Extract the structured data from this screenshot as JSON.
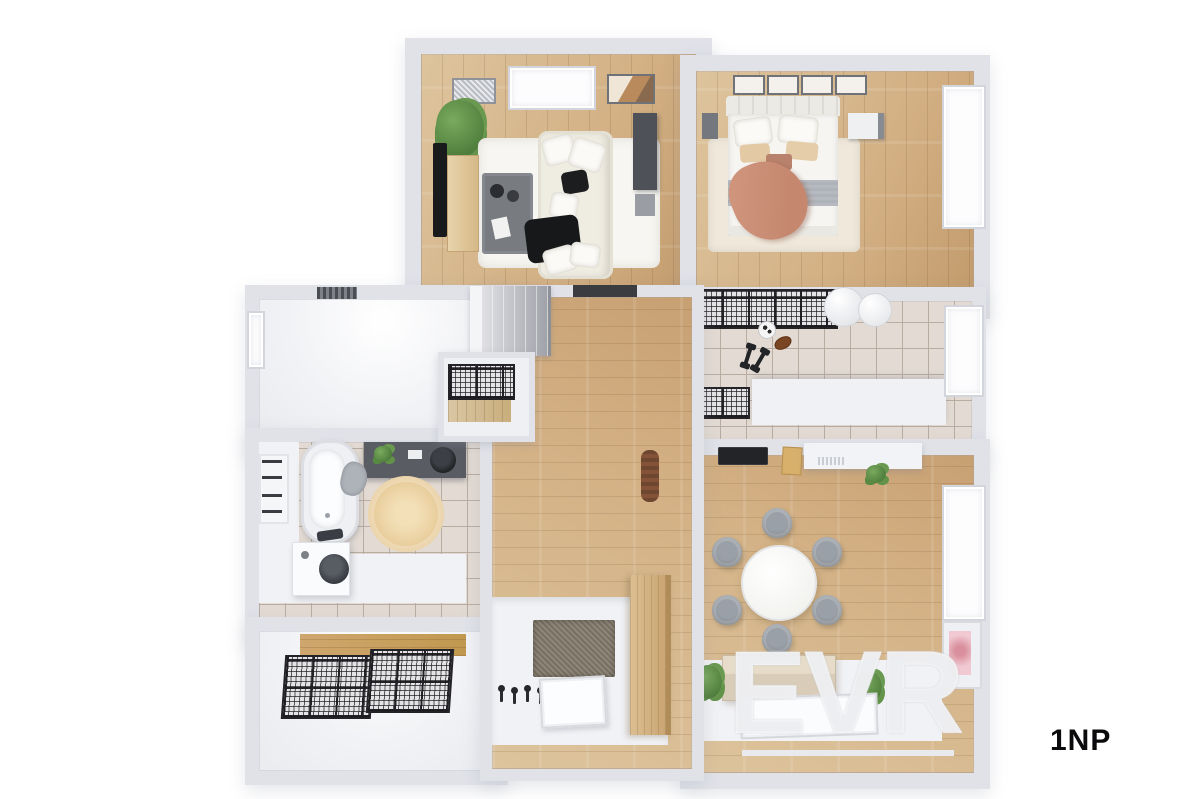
{
  "floor_plan": {
    "floor_label": "1NP",
    "watermark_text": "EVR",
    "rooms": [
      "living-room",
      "bedroom",
      "utility-room",
      "dining-kitchen",
      "entry-hall",
      "bathroom",
      "storage-room",
      "corridor"
    ],
    "palette": {
      "wall": "#e0e2e8",
      "wood": "#d3b084",
      "woodlight": "#ddc49d",
      "tile": "#e3dbd3",
      "tileline": "#b9ada2",
      "floorwhite": "#f1f2f5",
      "sofa": "#efece2",
      "terracotta": "#c5886f",
      "blanket": "#b6bac0",
      "chair": "#9aa0a7",
      "rug": "#ead0a0",
      "mesh": "#232327",
      "plantgreen": "#5f9048",
      "pink": "#f0c9d2",
      "brown": "#7b4b33",
      "darkunit": "#4e5157",
      "ink": "#0b0b0d"
    }
  }
}
